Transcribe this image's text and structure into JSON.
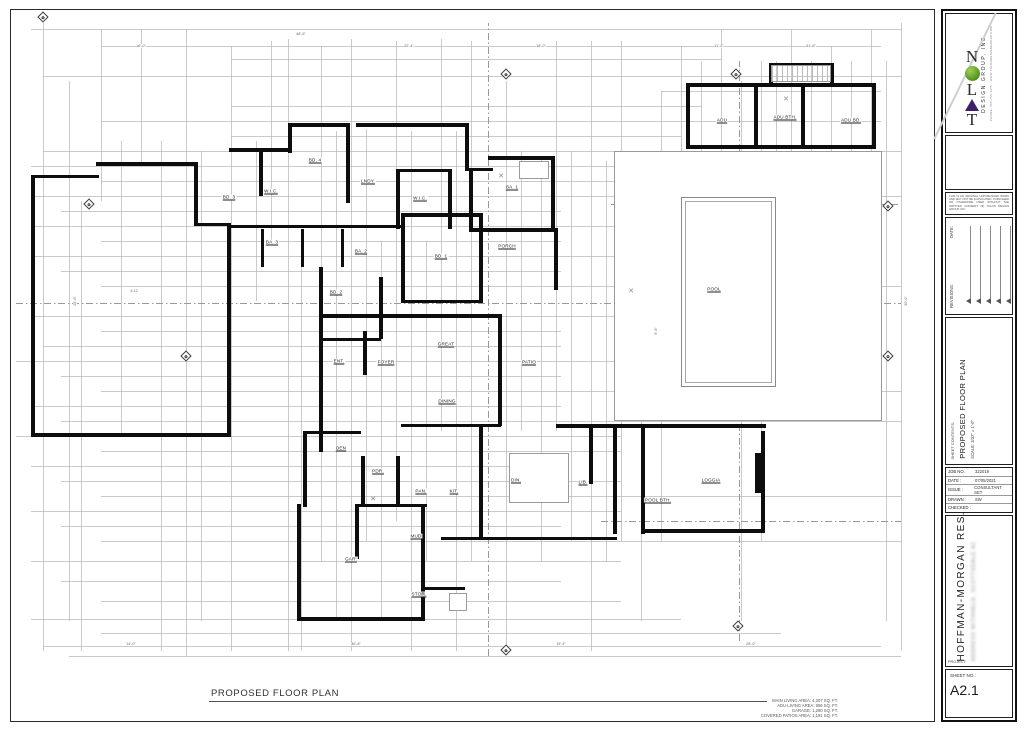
{
  "sheet": {
    "plan_title": "PROPOSED FLOOR PLAN",
    "area_notes": [
      "MAIN LIVING AREA: 4,307 SQ. FT.",
      "ADU LIVING AREA: 656 SQ. FT.",
      "GARAGE: 1,290 SQ. FT.",
      "COVERED PATIOS AREA: 1,191 SQ. FT."
    ]
  },
  "titleblock": {
    "logo": {
      "brand": "TALON",
      "sub": "DESIGN GROUP, INC.",
      "contact": "PHONE: 555.755.1475 · WWW.TALONDESIGNGROUP.COM",
      "o_color": "#5b9b21",
      "a_color": "#3d1f66"
    },
    "notice": "THIS IS AN ORIGINAL UNPUBLISHED WORK AND MAY NOT BE DUPLICATED, PUBLISHED OR OTHERWISE USED WITHOUT THE WRITTEN CONSENT OF TALON DESIGN GROUP, INC.",
    "date_label": "DATE:",
    "revisions_label": "REVISIONS:",
    "contents_label": "SHEET CONTENTS:",
    "contents_title": "PROPOSED FLOOR PLAN",
    "contents_scale": "SCALE: 3/32\" = 1'-0\"",
    "job": [
      {
        "label": "JOB NO.",
        "value": "322019"
      },
      {
        "label": "DATE :",
        "value": "07/05/2021"
      },
      {
        "label": "ISSUE :",
        "value": "CONSULTANT SET"
      },
      {
        "label": "DRAWN :",
        "value": "SW"
      },
      {
        "label": "CHECKED :",
        "value": ""
      }
    ],
    "project_label": "PROJECT:",
    "project_name": "HOFFMAN-MORGAN RES.",
    "project_address": "ADDRESS WITHHELD, SCOTTSDALE AZ",
    "sheet_no_label": "SHEET NO.:",
    "sheet_no": "A2.1"
  },
  "plan": {
    "thin_v": [
      [
        42,
        22,
        650
      ],
      [
        68,
        80,
        620
      ],
      [
        80,
        200,
        650
      ],
      [
        100,
        28,
        200
      ],
      [
        120,
        140,
        435
      ],
      [
        140,
        28,
        165
      ],
      [
        160,
        140,
        650
      ],
      [
        185,
        28,
        655
      ],
      [
        200,
        150,
        620
      ],
      [
        230,
        45,
        650
      ],
      [
        255,
        140,
        300
      ],
      [
        270,
        40,
        240
      ],
      [
        287,
        38,
        650
      ],
      [
        300,
        240,
        650
      ],
      [
        320,
        45,
        560
      ],
      [
        335,
        130,
        620
      ],
      [
        350,
        38,
        650
      ],
      [
        365,
        128,
        540
      ],
      [
        380,
        240,
        620
      ],
      [
        395,
        40,
        520
      ],
      [
        410,
        130,
        650
      ],
      [
        425,
        240,
        560
      ],
      [
        440,
        38,
        430
      ],
      [
        455,
        130,
        650
      ],
      [
        470,
        40,
        560
      ],
      [
        505,
        80,
        645
      ],
      [
        520,
        150,
        430
      ],
      [
        540,
        155,
        560
      ],
      [
        555,
        40,
        430
      ],
      [
        570,
        150,
        540
      ],
      [
        590,
        40,
        650
      ],
      [
        605,
        160,
        560
      ],
      [
        620,
        40,
        540
      ],
      [
        640,
        150,
        620
      ],
      [
        660,
        90,
        540
      ],
      [
        680,
        45,
        420
      ],
      [
        700,
        60,
        200
      ],
      [
        720,
        28,
        160
      ],
      [
        740,
        80,
        620
      ],
      [
        760,
        60,
        540
      ],
      [
        775,
        60,
        420
      ],
      [
        790,
        28,
        160
      ],
      [
        810,
        60,
        160
      ],
      [
        830,
        45,
        200
      ],
      [
        850,
        60,
        160
      ],
      [
        870,
        28,
        420
      ],
      [
        885,
        60,
        620
      ],
      [
        900,
        22,
        650
      ]
    ],
    "thin_h": [
      [
        28,
        30,
        900
      ],
      [
        45,
        100,
        880
      ],
      [
        58,
        230,
        720
      ],
      [
        75,
        42,
        900
      ],
      [
        90,
        660,
        880
      ],
      [
        105,
        230,
        700
      ],
      [
        120,
        100,
        880
      ],
      [
        135,
        230,
        680
      ],
      [
        150,
        42,
        900
      ],
      [
        165,
        30,
        680
      ],
      [
        180,
        100,
        620
      ],
      [
        195,
        30,
        900
      ],
      [
        210,
        60,
        560
      ],
      [
        225,
        30,
        620
      ],
      [
        240,
        100,
        560
      ],
      [
        255,
        30,
        880
      ],
      [
        270,
        60,
        560
      ],
      [
        285,
        100,
        900
      ],
      [
        315,
        30,
        620
      ],
      [
        330,
        100,
        560
      ],
      [
        345,
        42,
        560
      ],
      [
        360,
        15,
        620
      ],
      [
        375,
        60,
        560
      ],
      [
        390,
        100,
        900
      ],
      [
        405,
        30,
        560
      ],
      [
        420,
        60,
        900
      ],
      [
        435,
        15,
        620
      ],
      [
        450,
        100,
        620
      ],
      [
        465,
        30,
        560
      ],
      [
        480,
        60,
        620
      ],
      [
        495,
        100,
        900
      ],
      [
        510,
        30,
        620
      ],
      [
        525,
        60,
        560
      ],
      [
        540,
        100,
        900
      ],
      [
        560,
        30,
        620
      ],
      [
        580,
        60,
        560
      ],
      [
        600,
        100,
        620
      ],
      [
        618,
        30,
        680
      ],
      [
        632,
        100,
        780
      ],
      [
        645,
        42,
        880
      ],
      [
        655,
        68,
        900
      ]
    ],
    "dash_h": [
      [
        203,
        610,
        900
      ],
      [
        302,
        15,
        900
      ],
      [
        520,
        600,
        900
      ]
    ],
    "dash_v": [
      [
        487,
        22,
        655
      ],
      [
        738,
        60,
        640
      ]
    ],
    "walls": [
      [
        95,
        161,
        100,
        4
      ],
      [
        30,
        174,
        4,
        262
      ],
      [
        30,
        174,
        68,
        3
      ],
      [
        30,
        432,
        200,
        4
      ],
      [
        226,
        222,
        4,
        214
      ],
      [
        193,
        161,
        4,
        64
      ],
      [
        196,
        222,
        32,
        3
      ],
      [
        228,
        147,
        62,
        4
      ],
      [
        287,
        122,
        62,
        4
      ],
      [
        355,
        122,
        112,
        4
      ],
      [
        287,
        122,
        4,
        30
      ],
      [
        345,
        122,
        4,
        80
      ],
      [
        464,
        122,
        4,
        48
      ],
      [
        464,
        167,
        28,
        3
      ],
      [
        487,
        155,
        66,
        4
      ],
      [
        550,
        155,
        4,
        76
      ],
      [
        468,
        227,
        88,
        4
      ],
      [
        468,
        167,
        4,
        62
      ],
      [
        553,
        227,
        4,
        62
      ],
      [
        395,
        168,
        56,
        3
      ],
      [
        395,
        170,
        4,
        58
      ],
      [
        447,
        170,
        4,
        58
      ],
      [
        228,
        224,
        172,
        3
      ],
      [
        258,
        150,
        4,
        45
      ],
      [
        260,
        228,
        3,
        38
      ],
      [
        300,
        228,
        3,
        38
      ],
      [
        340,
        228,
        3,
        38
      ],
      [
        400,
        212,
        82,
        4
      ],
      [
        400,
        212,
        4,
        90
      ],
      [
        478,
        212,
        4,
        90
      ],
      [
        400,
        299,
        82,
        3
      ],
      [
        318,
        266,
        4,
        74
      ],
      [
        378,
        276,
        4,
        62
      ],
      [
        318,
        337,
        62,
        3
      ],
      [
        318,
        313,
        182,
        4
      ],
      [
        497,
        313,
        4,
        112
      ],
      [
        318,
        313,
        4,
        138
      ],
      [
        362,
        330,
        4,
        44
      ],
      [
        400,
        423,
        100,
        3
      ],
      [
        478,
        425,
        4,
        111
      ],
      [
        555,
        423,
        210,
        4
      ],
      [
        588,
        423,
        4,
        60
      ],
      [
        612,
        427,
        4,
        106
      ],
      [
        640,
        427,
        4,
        106
      ],
      [
        760,
        430,
        4,
        102
      ],
      [
        754,
        452,
        10,
        40
      ],
      [
        640,
        528,
        124,
        4
      ],
      [
        440,
        536,
        176,
        3
      ],
      [
        302,
        430,
        4,
        76
      ],
      [
        302,
        430,
        58,
        3
      ],
      [
        360,
        455,
        4,
        50
      ],
      [
        395,
        455,
        4,
        50
      ],
      [
        356,
        503,
        70,
        3
      ],
      [
        296,
        503,
        4,
        116
      ],
      [
        296,
        616,
        128,
        4
      ],
      [
        420,
        558,
        4,
        60
      ],
      [
        354,
        503,
        4,
        55
      ],
      [
        420,
        503,
        4,
        57
      ],
      [
        422,
        586,
        42,
        3
      ],
      [
        688,
        82,
        187,
        4
      ],
      [
        685,
        82,
        4,
        66
      ],
      [
        871,
        82,
        4,
        66
      ],
      [
        688,
        144,
        187,
        4
      ],
      [
        753,
        84,
        4,
        60
      ],
      [
        800,
        84,
        4,
        60
      ],
      [
        768,
        62,
        64,
        3
      ],
      [
        768,
        62,
        4,
        20
      ],
      [
        829,
        62,
        4,
        20
      ]
    ],
    "pool": {
      "outer": [
        680,
        196,
        95,
        190
      ],
      "inner": [
        684,
        200,
        87,
        182
      ]
    },
    "fixtures": [
      [
        508,
        452,
        60,
        50
      ],
      [
        518,
        160,
        30,
        18
      ],
      [
        613,
        150,
        268,
        270
      ],
      [
        448,
        592,
        18,
        18
      ]
    ],
    "hatches": [
      [
        770,
        64,
        60,
        17
      ]
    ],
    "xmarks": [
      [
        500,
        175
      ],
      [
        785,
        98
      ],
      [
        372,
        498
      ],
      [
        630,
        290
      ]
    ],
    "rooms": [
      [
        "BD. 3",
        228,
        196
      ],
      [
        "W.I.C.",
        270,
        190
      ],
      [
        "BD. 4",
        314,
        159
      ],
      [
        "LNDY.",
        367,
        180
      ],
      [
        "W.I.C.",
        419,
        197
      ],
      [
        "BA. 1",
        511,
        186
      ],
      [
        "BA. 3",
        271,
        241
      ],
      [
        "BA. 2",
        360,
        250
      ],
      [
        "BD. 2",
        335,
        291
      ],
      [
        "BD. 1",
        440,
        255
      ],
      [
        "PORCH",
        506,
        245
      ],
      [
        "ENT.",
        338,
        360
      ],
      [
        "FOYER",
        385,
        361
      ],
      [
        "GREAT",
        445,
        343
      ],
      [
        "PATIO",
        528,
        361
      ],
      [
        "DINING",
        446,
        400
      ],
      [
        "DEN",
        340,
        447
      ],
      [
        "PDR.",
        377,
        470
      ],
      [
        "PAN.",
        420,
        490
      ],
      [
        "KIT.",
        453,
        490
      ],
      [
        "DIN.",
        515,
        479
      ],
      [
        "LIB.",
        582,
        481
      ],
      [
        "MUD",
        415,
        535
      ],
      [
        "GAR.",
        350,
        558
      ],
      [
        "STOR.",
        418,
        593
      ],
      [
        "POOL",
        713,
        288
      ],
      [
        "LOGGIA",
        710,
        479
      ],
      [
        "POOL BTH.",
        657,
        499
      ],
      [
        "ADU",
        721,
        119
      ],
      [
        "ADU BTH.",
        784,
        116
      ],
      [
        "ADU BD.",
        850,
        119
      ]
    ],
    "markers": [
      [
        42,
        16
      ],
      [
        88,
        203
      ],
      [
        505,
        73
      ],
      [
        735,
        73
      ],
      [
        887,
        205
      ],
      [
        887,
        355
      ],
      [
        185,
        355
      ],
      [
        505,
        649
      ],
      [
        737,
        625
      ]
    ],
    "dims": [
      [
        "48'-6\"",
        300,
        33,
        0
      ],
      [
        "16'-0\"",
        140,
        45,
        0
      ],
      [
        "22'-4\"",
        408,
        45,
        0
      ],
      [
        "18'-0\"",
        540,
        45,
        0
      ],
      [
        "11'-2\"",
        718,
        45,
        0
      ],
      [
        "31'-8\"",
        810,
        45,
        0
      ],
      [
        "24'-6\"",
        74,
        300,
        1
      ],
      [
        "30'-0\"",
        905,
        300,
        1
      ],
      [
        "9'-6\"",
        655,
        330,
        1
      ],
      [
        "14'-0\"",
        130,
        643,
        0
      ],
      [
        "36'-8\"",
        355,
        643,
        0
      ],
      [
        "19'-4\"",
        560,
        643,
        0
      ],
      [
        "28'-0\"",
        750,
        643,
        0
      ],
      [
        "4:12",
        133,
        290,
        0
      ]
    ]
  }
}
